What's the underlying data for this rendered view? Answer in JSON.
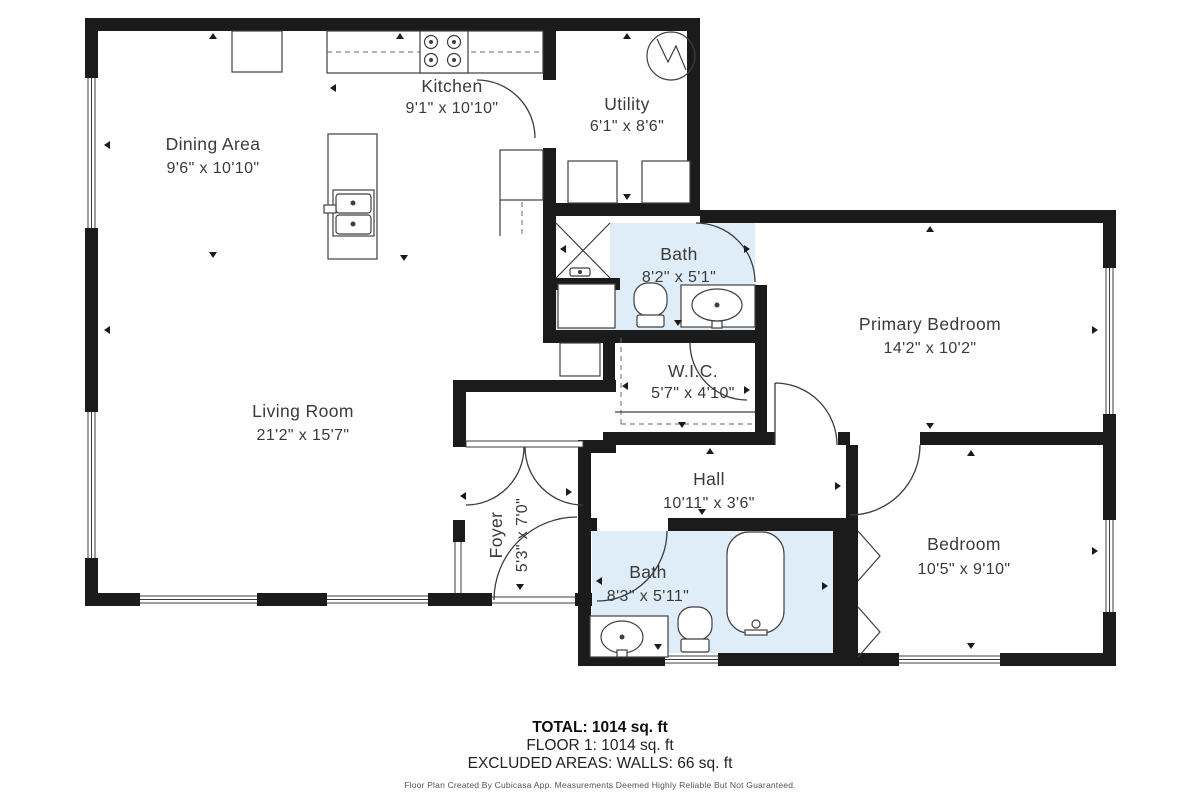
{
  "rooms": {
    "dining": {
      "name": "Dining Area",
      "dims": "9'6\" x 10'10\""
    },
    "kitchen": {
      "name": "Kitchen",
      "dims": "9'1\" x 10'10\""
    },
    "utility": {
      "name": "Utility",
      "dims": "6'1\" x 8'6\""
    },
    "bath1": {
      "name": "Bath",
      "dims": "8'2\" x 5'1\""
    },
    "primary_bedroom": {
      "name": "Primary Bedroom",
      "dims": "14'2\" x 10'2\""
    },
    "wic": {
      "name": "W.I.C.",
      "dims": "5'7\" x 4'10\""
    },
    "living": {
      "name": "Living Room",
      "dims": "21'2\" x 15'7\""
    },
    "hall": {
      "name": "Hall",
      "dims": "10'11\" x 3'6\""
    },
    "foyer": {
      "name": "Foyer",
      "dims": "5'3\" x 7'0\""
    },
    "bath2": {
      "name": "Bath",
      "dims": "8'3\" x 5'11\""
    },
    "bedroom": {
      "name": "Bedroom",
      "dims": "10'5\" x 9'10\""
    }
  },
  "summary": {
    "total": "TOTAL: 1014 sq. ft",
    "floor": "FLOOR 1: 1014 sq. ft",
    "excluded": "EXCLUDED AREAS: WALLS: 66 sq. ft",
    "footer": "Floor Plan Created By Cubicasa App. Measurements Deemed Highly Reliable But Not Guaranteed."
  },
  "colors": {
    "wall": "#1b1b1b",
    "bath_fill": "#deedf8",
    "label_text": "#3a3a3a",
    "fixture_stroke": "#3f3f3f",
    "background": "#ffffff"
  }
}
